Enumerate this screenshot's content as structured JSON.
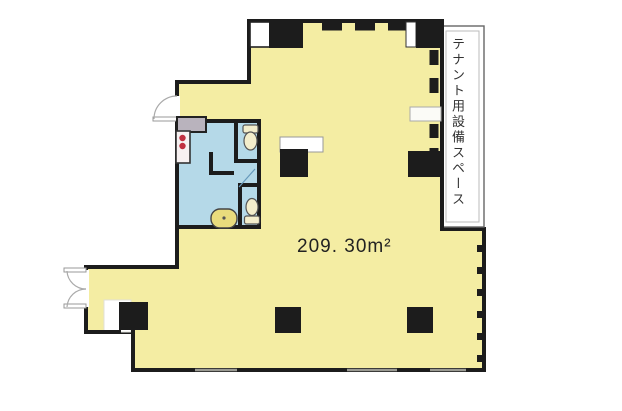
{
  "plan": {
    "area_label": "209. 30m²",
    "equipment_space": {
      "label": "テナント用設備スペース"
    },
    "colors": {
      "floor": "#f4eda3",
      "wet_area": "#b5d9e8",
      "wall": "#1c1c1c",
      "counter": "#b9b3bd",
      "fixture": "#f3edcb",
      "sink_basin": "#e9dc7d",
      "burner": "#c03040",
      "background": "#ffffff",
      "window_segment": "#9a9a92"
    }
  }
}
